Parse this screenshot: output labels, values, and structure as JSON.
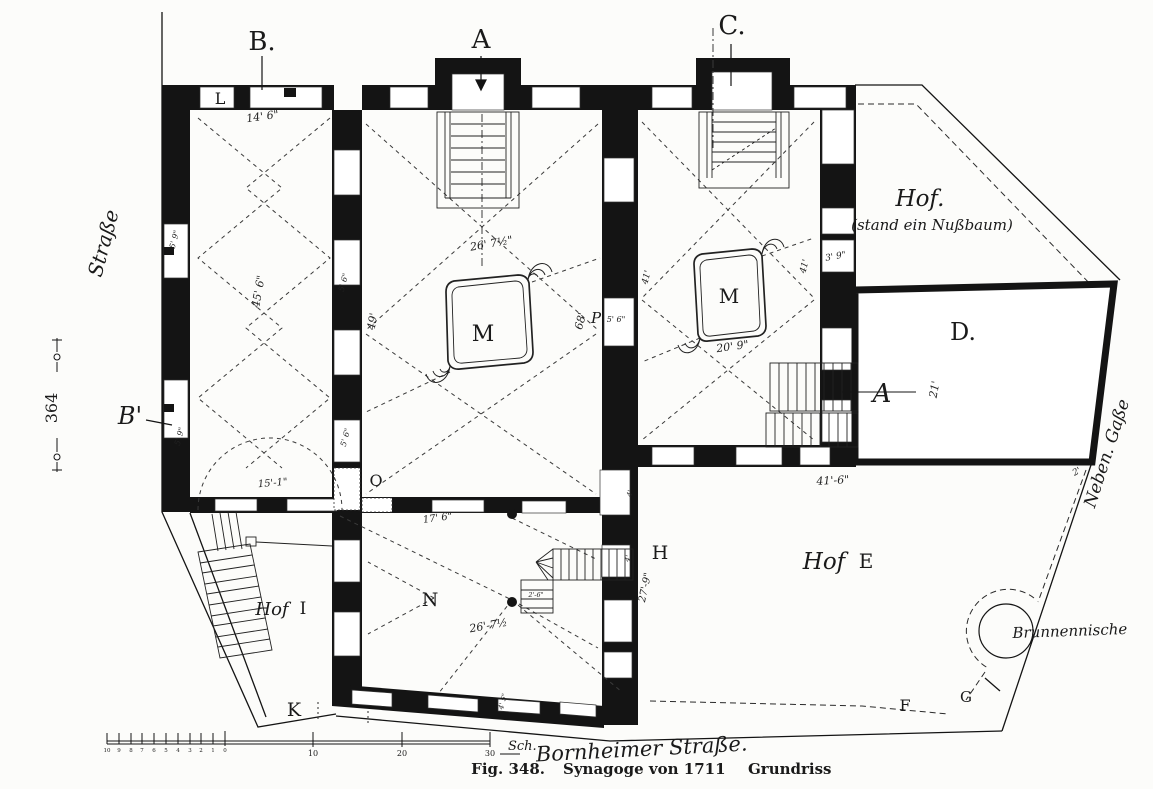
{
  "figure": {
    "caption_fig": "Fig. 348.",
    "caption_title": "Synagoge von 1711",
    "caption_sub": "Grundriss",
    "page_number": "364"
  },
  "markers": {
    "b": "B.",
    "a": "A",
    "c": "C.",
    "b_prime": "B'",
    "a_ref": "A"
  },
  "rooms": {
    "l": "L",
    "o": "O",
    "n": "N",
    "k": "K",
    "h": "H",
    "m_main": "M",
    "m_right": "M",
    "p": "P",
    "d": "D.",
    "e": "E",
    "f": "F",
    "g": "G",
    "i": "I"
  },
  "hof": {
    "d_line1": "Hof.",
    "d_line2": "(stand ein Nußbaum)",
    "e": "Hof",
    "i": "Hof"
  },
  "streets": {
    "left": "Straße",
    "right": "Neben. Gaße",
    "bottom": "Bornheimer Straße.",
    "well": "Brunnennische"
  },
  "dimensions": {
    "d_14_6": "14' 6\"",
    "d_45_6": "45' 6\"",
    "d_5_9_a": "5' 9\"",
    "d_5_9_b": "5' 9\"",
    "d_5_6_a": "5' 6\"",
    "d_5_6_b": "5' 6\"",
    "d_5_6_p": "5' 6\"",
    "d_26_7_main": "26' 7½\"",
    "d_49": "49'",
    "d_68": "68'",
    "d_41_a": "41'",
    "d_41_b": "41'",
    "d_3_9": "3' 9\"",
    "d_20_9": "20' 9\"",
    "d_15_1": "15'-1\"",
    "d_17_6": "17' 6\"",
    "d_26_7_n": "26'-7½",
    "d_2_6": "2'-6\"",
    "d_27_9": "27'-9\"",
    "d_41_6": "41'-6\"",
    "d_21": "21'",
    "d_2": "2'",
    "d_4_5": "4' 5\"",
    "d_4_a": "4'",
    "d_4_b": "4'"
  },
  "scale_bar": {
    "minor_labels": [
      "10",
      "9",
      "8",
      "7",
      "6",
      "5",
      "4",
      "3",
      "2",
      "1",
      "0"
    ],
    "major_labels": [
      "10",
      "20",
      "30"
    ],
    "unit": "Sch."
  },
  "colors": {
    "paper": "#fcfcfa",
    "ink": "#141414"
  }
}
